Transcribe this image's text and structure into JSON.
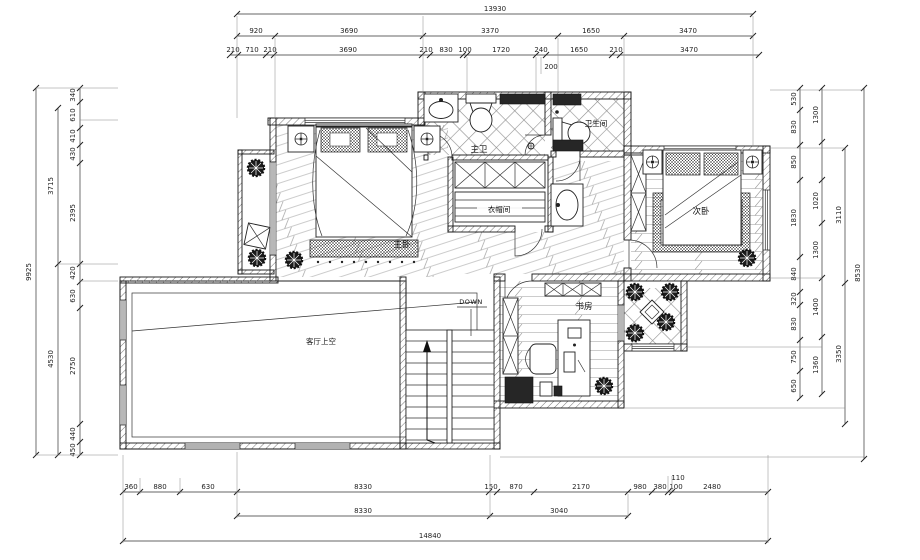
{
  "rooms": {
    "master_bedroom": "主卧",
    "second_bedroom": "次卧",
    "master_bath": "主卫",
    "bathroom": "卫生间",
    "cloakroom": "衣帽间",
    "study": "书房",
    "void": "客厅上空",
    "stairs_down": "DOWN"
  },
  "dims": {
    "top": {
      "total": "13930",
      "row2": [
        "920",
        "3690",
        "3370",
        "1650",
        "3470"
      ],
      "row3": [
        "210",
        "710",
        "210",
        "3690",
        "210",
        "830",
        "100",
        "1720",
        "240",
        "1650",
        "210",
        "3470"
      ],
      "sub": "200"
    },
    "bottom": {
      "row1": [
        "360",
        "880",
        "630",
        "8330",
        "150",
        "870",
        "2170",
        "980",
        "380",
        "100",
        "2480"
      ],
      "sub": "110",
      "row2": [
        "8330",
        "3040"
      ],
      "total": "14840"
    },
    "left": {
      "inner": [
        "340",
        "610",
        "410",
        "430",
        "2395",
        "420",
        "630",
        "2750",
        "440",
        "450"
      ],
      "mid": [
        "3715",
        "4530"
      ],
      "total": "9925"
    },
    "right": {
      "inner": [
        "530",
        "830",
        "850",
        "1830",
        "840",
        "320",
        "830",
        "750",
        "650"
      ],
      "mid": [
        "1300",
        "1020",
        "1300",
        "1400",
        "1360"
      ],
      "outer": [
        "3110",
        "3350"
      ],
      "total": "8530"
    }
  },
  "colors": {
    "line": "#1f1f1f",
    "bg": "#ffffff",
    "hatch": "#666666"
  }
}
